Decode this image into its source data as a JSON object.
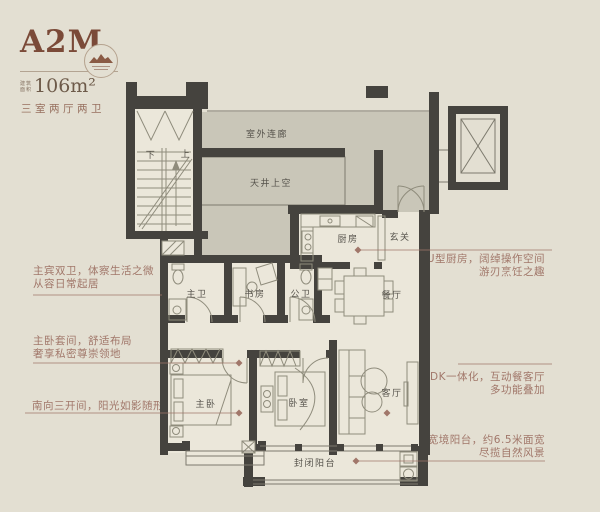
{
  "header": {
    "title": "A2M",
    "area_prefix_line1": "建筑",
    "area_prefix_line2": "面积",
    "area_value": "106m²",
    "type_label": "三室两厅两卫"
  },
  "logo": {
    "name": "mountain-emblem"
  },
  "plan": {
    "rooms": {
      "corridor": "室外连廊",
      "patio": "天井上空",
      "kitchen": "厨房",
      "foyer": "玄关",
      "master_bath": "主卫",
      "study": "书房",
      "guest_bath": "公卫",
      "dining": "餐厅",
      "master_bed": "主卧",
      "bedroom": "卧室",
      "living": "客厅",
      "balcony": "封闭阳台",
      "stair_down": "下",
      "stair_up": "上"
    }
  },
  "annotations": {
    "left": [
      {
        "line1": "主宾双卫，体察生活之微",
        "line2": "从容日常起居"
      },
      {
        "line1": "主卧套间，舒适布局",
        "line2": "奢享私密尊崇领地"
      },
      {
        "line1": "南向三开间，阳光如影随形",
        "line2": ""
      }
    ],
    "right": [
      {
        "line1": "U型厨房，阔绰操作空间",
        "line2": "游刃烹饪之趣"
      },
      {
        "line1": "LDK一体化，互动餐客厅",
        "line2": "多功能叠加"
      },
      {
        "line1": "宽境阳台，约6.5米面宽",
        "line2": "尽揽自然风景"
      }
    ]
  },
  "colors": {
    "background": "#e3dfd2",
    "wall": "#45433e",
    "public_zone": "#c9c6b8",
    "room_fill": "#ebe7da",
    "accent_text": "#a1776a",
    "title_text": "#7b4a38",
    "room_label": "#55524b"
  }
}
